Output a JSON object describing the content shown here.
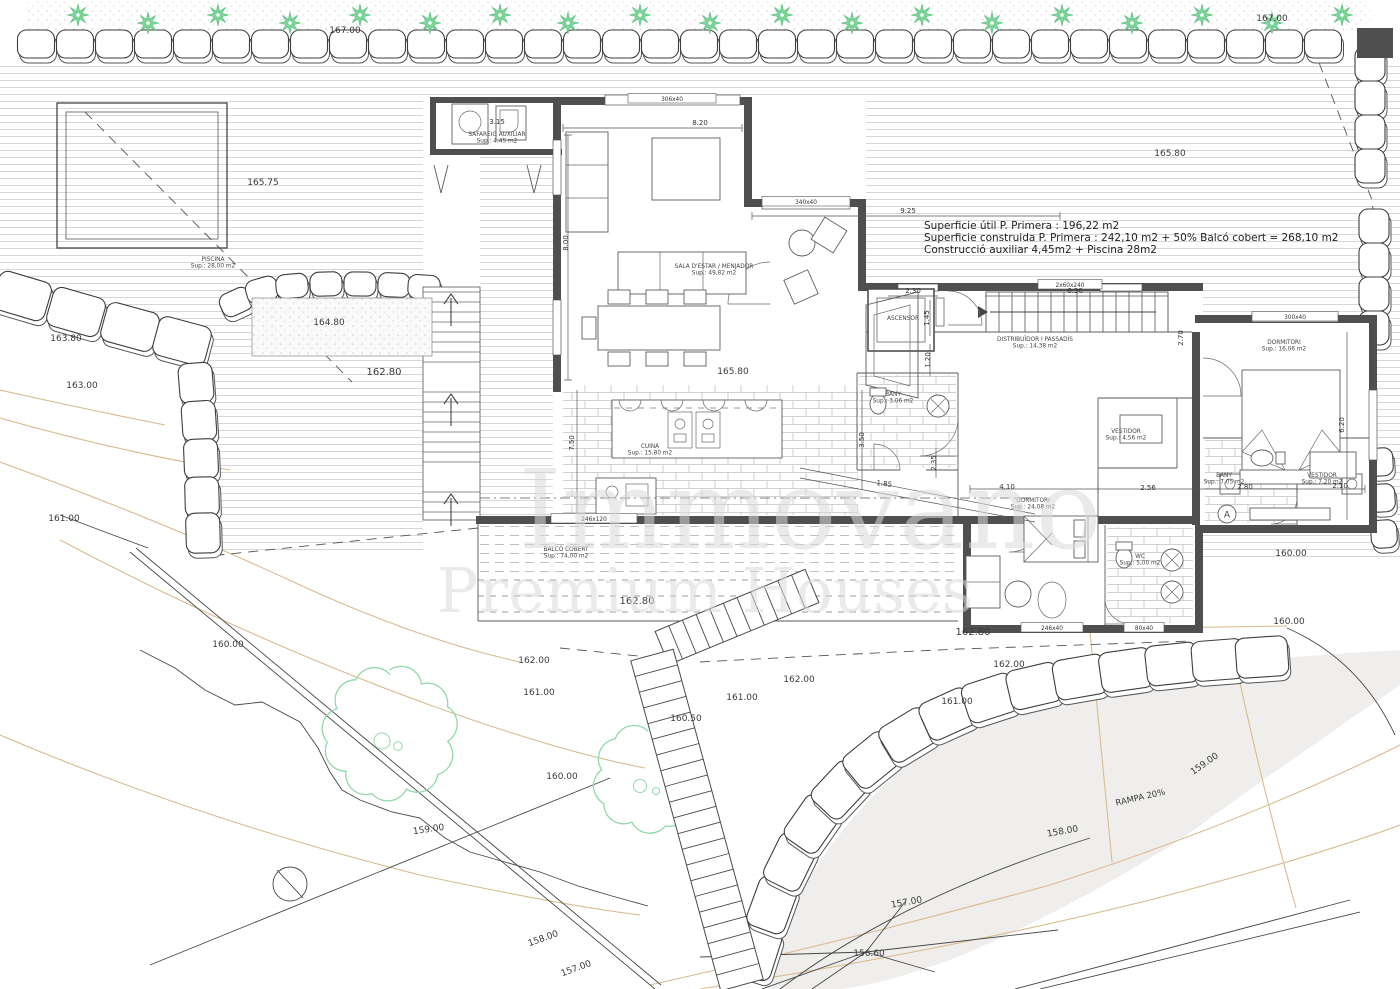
{
  "title": "Plànol planta primera i emplaçament",
  "colors": {
    "wall": "#4f4f4f",
    "plant_green": "#7cd49a",
    "tree_green": "#8fd9a8",
    "contour_tan": "#d9bc8e",
    "ramp_gray": "#efeeec",
    "hatch_gray": "#c9c9c9",
    "text_dark": "#2e2e2e",
    "watermark_gray": "#d9d9d9"
  },
  "annotation": {
    "line1": "Superficie útil P. Primera : 196,22 m2",
    "line2": "Superficie construida P. Primera : 242,10 m2 + 50% Balcó cobert = 268,10 m2",
    "line3": "Construcció auxiliar 4,45m2 + Piscina 28m2"
  },
  "watermark": {
    "line1": "Immovano",
    "line2": "Premium Houses"
  },
  "elevation_labels": [
    {
      "t": "167.00",
      "x": 345,
      "y": 33
    },
    {
      "t": "167.00",
      "x": 1272,
      "y": 21
    },
    {
      "t": "165.75",
      "x": 263,
      "y": 185
    },
    {
      "t": "165.80",
      "x": 1170,
      "y": 156
    },
    {
      "t": "164.80",
      "x": 329,
      "y": 325
    },
    {
      "t": "163.80",
      "x": 66,
      "y": 341
    },
    {
      "t": "163.00",
      "x": 82,
      "y": 388
    },
    {
      "t": "162.80",
      "x": 384,
      "y": 375,
      "fs": 10
    },
    {
      "t": "165.80",
      "x": 733,
      "y": 374
    },
    {
      "t": "161.00",
      "x": 64,
      "y": 521
    },
    {
      "t": "160.00",
      "x": 228,
      "y": 647
    },
    {
      "t": "162.80",
      "x": 637,
      "y": 604,
      "fs": 10
    },
    {
      "t": "162.00",
      "x": 534,
      "y": 663
    },
    {
      "t": "161.00",
      "x": 539,
      "y": 695
    },
    {
      "t": "160.00",
      "x": 562,
      "y": 779
    },
    {
      "t": "160.50",
      "x": 686,
      "y": 721
    },
    {
      "t": "161.00",
      "x": 742,
      "y": 700
    },
    {
      "t": "162.00",
      "x": 799,
      "y": 682
    },
    {
      "t": "162.00",
      "x": 1009,
      "y": 667
    },
    {
      "t": "161.00",
      "x": 957,
      "y": 704
    },
    {
      "t": "159.00",
      "x": 429,
      "y": 832,
      "rot": -8
    },
    {
      "t": "158.00",
      "x": 544,
      "y": 941,
      "rot": -20
    },
    {
      "t": "157.00",
      "x": 577,
      "y": 971,
      "rot": -20
    },
    {
      "t": "162.80",
      "x": 973,
      "y": 635,
      "fs": 10
    },
    {
      "t": "160.00",
      "x": 1291,
      "y": 556
    },
    {
      "t": "160.00",
      "x": 1289,
      "y": 624
    },
    {
      "t": "159.00",
      "x": 1206,
      "y": 766,
      "rot": -35
    },
    {
      "t": "158.00",
      "x": 1063,
      "y": 834,
      "rot": -10
    },
    {
      "t": "157.00",
      "x": 907,
      "y": 905,
      "rot": -10
    },
    {
      "t": "156.60",
      "x": 869,
      "y": 956
    },
    {
      "t": "RAMPA 20%",
      "x": 1141,
      "y": 800,
      "rot": -13,
      "fs": 8.5
    }
  ],
  "dimension_labels": [
    {
      "t": "8.20",
      "x": 700,
      "y": 125
    },
    {
      "t": "3.15",
      "x": 497,
      "y": 124
    },
    {
      "t": "9.25",
      "x": 908,
      "y": 213
    },
    {
      "t": "8.00",
      "x": 568,
      "y": 243,
      "rot": -90
    },
    {
      "t": "2.30",
      "x": 913,
      "y": 293
    },
    {
      "t": "6.30",
      "x": 1075,
      "y": 293
    },
    {
      "t": "1.45",
      "x": 929,
      "y": 318,
      "rot": -90
    },
    {
      "t": "1.20",
      "x": 930,
      "y": 360,
      "rot": -90
    },
    {
      "t": "2.70",
      "x": 1183,
      "y": 338,
      "rot": -90
    },
    {
      "t": "6.20",
      "x": 1344,
      "y": 425,
      "rot": -90
    },
    {
      "t": "2.35",
      "x": 936,
      "y": 463,
      "rot": -90
    },
    {
      "t": "7.50",
      "x": 574,
      "y": 443,
      "rot": -90
    },
    {
      "t": "3.50",
      "x": 864,
      "y": 440,
      "rot": -90
    },
    {
      "t": "1.85",
      "x": 884,
      "y": 486,
      "rot": 6
    },
    {
      "t": "4.10",
      "x": 1007,
      "y": 489
    },
    {
      "t": "2.56",
      "x": 1148,
      "y": 490
    },
    {
      "t": "2.80",
      "x": 1245,
      "y": 489
    },
    {
      "t": "2.10",
      "x": 1340,
      "y": 488
    }
  ],
  "window_tags": [
    {
      "t": "306x40",
      "x": 672,
      "y": 101,
      "w": 88
    },
    {
      "t": "340x40",
      "x": 806,
      "y": 204,
      "w": 88
    },
    {
      "t": "2x60x240",
      "x": 1070,
      "y": 287,
      "w": 64
    },
    {
      "t": "300x40",
      "x": 1295,
      "y": 319,
      "w": 86
    },
    {
      "t": "246x120",
      "x": 594,
      "y": 521,
      "w": 86
    },
    {
      "t": "246x40",
      "x": 1052,
      "y": 630,
      "w": 62
    },
    {
      "t": "80x40",
      "x": 1144,
      "y": 630,
      "w": 40
    }
  ],
  "room_labels": [
    {
      "lines": [
        "SAFAREIG AUXILIAR",
        "Sup.: 4,45 m2"
      ],
      "x": 497,
      "y": 136
    },
    {
      "lines": [
        "SALA D'ESTAR / MENJADOR",
        "Sup.: 49,82 m2"
      ],
      "x": 714,
      "y": 268
    },
    {
      "lines": [
        "CUINA",
        "Sup.: 15,80 m2"
      ],
      "x": 650,
      "y": 448
    },
    {
      "lines": [
        "PISCINA",
        "Sup.: 28,00 m2"
      ],
      "x": 213,
      "y": 261
    },
    {
      "lines": [
        "BALCÓ COBERT",
        "Sup.: 74,00 m2"
      ],
      "x": 566,
      "y": 551
    },
    {
      "lines": [
        "ASCENSOR"
      ],
      "x": 903,
      "y": 320
    },
    {
      "lines": [
        "DISTRIBUÏDOR I PASSADÍS",
        "Sup.: 14,38 m2"
      ],
      "x": 1035,
      "y": 341
    },
    {
      "lines": [
        "BANY",
        "Sup.: 3,06 m2"
      ],
      "x": 893,
      "y": 396
    },
    {
      "lines": [
        "DORMITORI",
        "Sup.: 16,06 m2"
      ],
      "x": 1284,
      "y": 344
    },
    {
      "lines": [
        "VESTIDOR",
        "Sup.: 4,56 m2"
      ],
      "x": 1126,
      "y": 433
    },
    {
      "lines": [
        "DORMITORI",
        "Sup.: 24,08 m2"
      ],
      "x": 1033,
      "y": 502
    },
    {
      "lines": [
        "BANY",
        "Sup.: 7,05 m2"
      ],
      "x": 1224,
      "y": 477
    },
    {
      "lines": [
        "VESTIDOR",
        "Sup.: 7,20 m2"
      ],
      "x": 1322,
      "y": 477
    },
    {
      "lines": [
        "WC",
        "Sup.: 5,00 m2"
      ],
      "x": 1140,
      "y": 558
    }
  ]
}
